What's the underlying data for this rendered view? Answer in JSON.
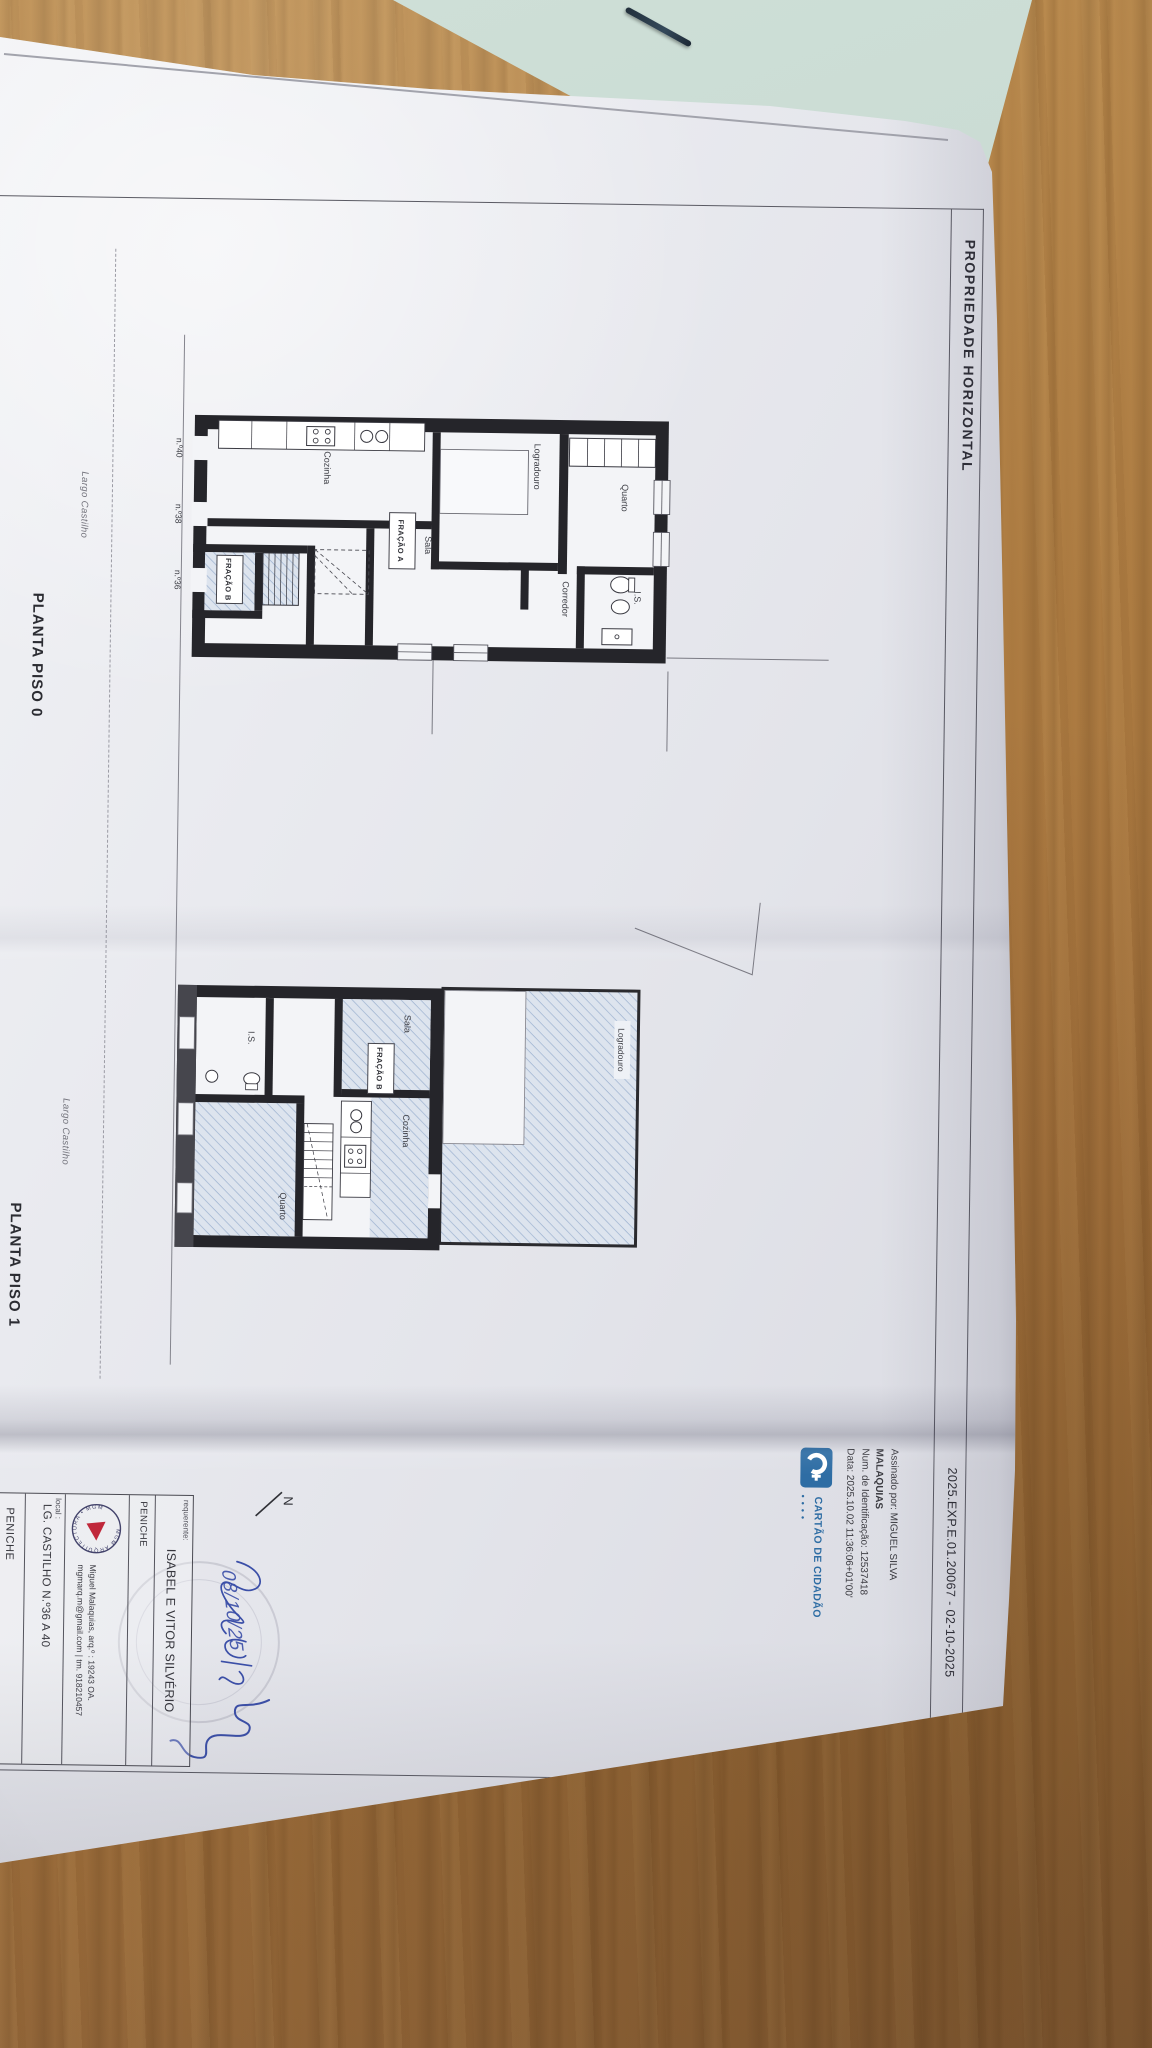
{
  "photo": {
    "colors": {
      "wood": "#a9763f",
      "paper": "#e8e9ee",
      "green_paper": "#c6d8d0",
      "accent_blue": "#2e6da4",
      "ink_blue": "#3b4fa8",
      "hatch_blue": "#9db2d0",
      "stamp_red": "#c0273a"
    }
  },
  "document": {
    "header": {
      "title": "PROPRIEDADE HORIZONTAL",
      "reference": "2025.EXP.E.01.20067 - 02-10-2025"
    },
    "plan0": {
      "caption": "PLANTA PISO 0",
      "street": "Largo Castilho",
      "rooms": {
        "quarto": "Quarto",
        "is": "I.S.",
        "corredor": "Corredor",
        "logradouro": "Logradouro",
        "sala": "Sala",
        "cozinha": "Cozinha"
      },
      "units": {
        "a": "FRAÇÃO A",
        "b": "FRAÇÃO B"
      },
      "doors": [
        "n.º40",
        "n.º38",
        "n.º36"
      ]
    },
    "plan1": {
      "caption": "PLANTA PISO 1",
      "street": "Largo Castilho",
      "rooms": {
        "logradouro": "Logradouro",
        "sala": "Sala",
        "cozinha": "Cozinha",
        "quarto": "Quarto",
        "is": "I.S."
      },
      "units": {
        "b": "FRAÇÃO B"
      }
    },
    "signature": {
      "line1": "Assinado por: MIGUEL SILVA",
      "line2": "MALAQUIAS",
      "line3": "Num. de Identificação: 12537418",
      "line4": "Data: 2025.10.02 11:36:06+01'00'"
    },
    "citizen_card": {
      "label": "CARTÃO DE CIDADÃO",
      "dots": "••••"
    },
    "north": "N",
    "handwriting": {
      "date": "08/10/25"
    },
    "title_block": {
      "requerente_label": "requerente:",
      "requerente": "ISABEL E VITOR SILVÉRIO",
      "municipality": "PENICHE",
      "stamp_text": "MGM ARQUITECTURA • MGM",
      "architect_line1": "Miguel Malaquias, arq.º  :  19243 OA.",
      "architect_line2": "mgmarq.m@gmail.com  |  tm. 918210457",
      "local_label": "local :",
      "local_value": "LG. CASTILHO N.º36 A 40",
      "local_municipality": "PENICHE"
    }
  }
}
